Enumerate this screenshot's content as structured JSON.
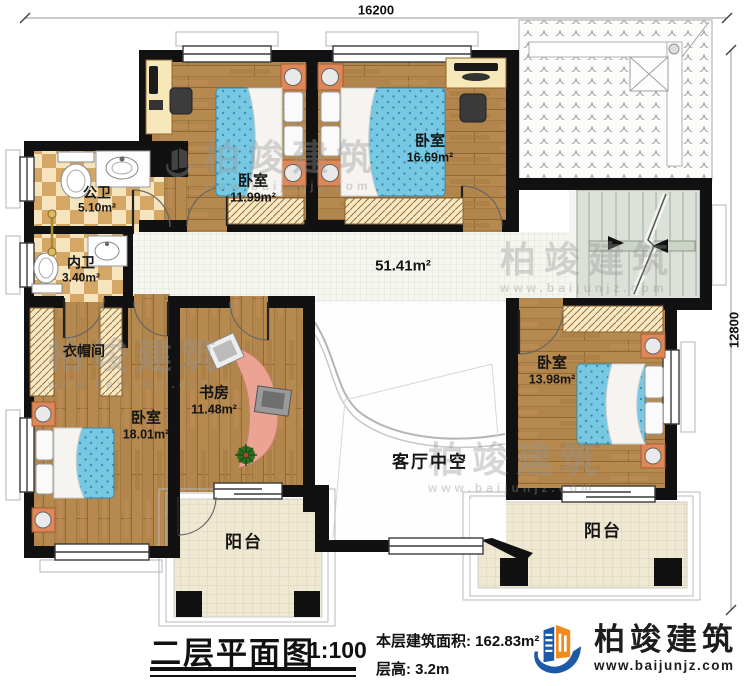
{
  "dimensions": {
    "width_label": "16200",
    "height_label": "12800"
  },
  "rooms": {
    "public_bath": {
      "name": "公卫",
      "area": "5.10m²"
    },
    "inner_bath": {
      "name": "内卫",
      "area": "3.40m²"
    },
    "bedroom_top_left": {
      "name": "卧室",
      "area": "11.99m²"
    },
    "bedroom_top_right": {
      "name": "卧室",
      "area": "16.69m²"
    },
    "cloakroom": {
      "name": "衣帽间"
    },
    "bedroom_left": {
      "name": "卧室",
      "area": "18.01m²"
    },
    "study": {
      "name": "书房",
      "area": "11.48m²"
    },
    "bedroom_right": {
      "name": "卧室",
      "area": "13.98m²"
    },
    "hall": {
      "area": "51.41m²"
    },
    "living_void": {
      "name": "客厅中空"
    },
    "balcony_left": {
      "name": "阳台"
    },
    "balcony_right": {
      "name": "阳台"
    }
  },
  "footer": {
    "title": "二层平面图",
    "scale": "1:100",
    "floor_area": "本层建筑面积: 162.83m²",
    "floor_height": "层高: 3.2m"
  },
  "brand": {
    "name": "柏竣建筑",
    "website": "www.baijunjz.com"
  },
  "watermark": {
    "name": "柏竣建筑",
    "website": "www.baijunjz.com"
  },
  "colors": {
    "wall": "#111111",
    "wood": "#b1854c",
    "bath_tile": "#d4a765",
    "hall_tile": "#f6f6f1",
    "stairs": "#dbe1d8",
    "balcony_tile": "#efe9d3",
    "mattress": "#76c8e3",
    "nightstand": "#df8757",
    "logo_blue": "#1c5aa8",
    "logo_orange": "#f18a1d"
  },
  "icons": {
    "bed": "bed-icon",
    "toilet": "toilet-icon",
    "sink": "sink-icon",
    "wardrobe": "wardrobe-icon",
    "stairs": "stairs-icon",
    "door": "door-swing-icon",
    "window": "window-icon",
    "desk": "desk-icon",
    "chair": "chair-icon",
    "plant": "plant-icon",
    "roof": "roof-tiles-icon",
    "radiator": "radiator-icon",
    "logo": "brand-logo-icon"
  }
}
